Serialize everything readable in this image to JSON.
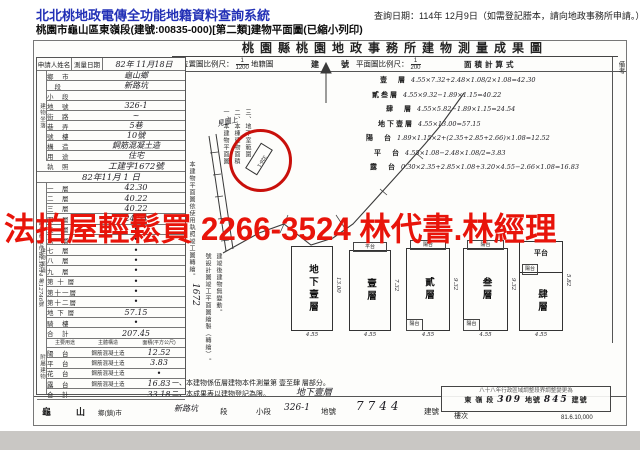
{
  "header": {
    "system_title": "北北桃地政電傳全功能地籍資料查詢系統",
    "query_date": "查詢日期：114年 12月9日（如需登記謄本，請向地政事務所申請。）",
    "subtitle": "桃園市龜山區東嶺段(建號:00835-000)[第二類]建物平面圖(已縮小列印)"
  },
  "watermark": {
    "text": "法拍屋輕鬆買 2266-3524 林代書.林經理",
    "color": "#e8140a"
  },
  "form": {
    "title": "桃園縣桃園地政事務所建物測量成果圖",
    "applicant_label": "申請人姓名",
    "survey_date_label": "測量日期",
    "survey_date": "82年 11月18日",
    "location_rows": [
      {
        "label": "鄉　市",
        "value": "龜山鄉"
      },
      {
        "label": "　段",
        "value": "新路坑"
      },
      {
        "label": "小　段",
        "value": ""
      },
      {
        "label": "地　號",
        "value": "326-1"
      },
      {
        "label": "街　路",
        "value": "~"
      },
      {
        "label": "巷　弄",
        "value": "5巷"
      },
      {
        "label": "號　樓",
        "value": "10號"
      },
      {
        "label": "構　造",
        "value": "鋼筋混凝土造"
      },
      {
        "label": "用　途",
        "value": "住宅"
      }
    ],
    "license_label": "執　照",
    "license_no": "工建字1672號",
    "license_date": "82年11月 1 日",
    "location_group_label": "建物坐落",
    "area_group_label": "建物面積",
    "annex_group_label": "附屬建物",
    "area_rows": [
      {
        "label": "一　層",
        "value": "42.30"
      },
      {
        "label": "二　層",
        "value": "40.22"
      },
      {
        "label": "三　層",
        "value": "40.22"
      },
      {
        "label": "四　層",
        "value": "24.54"
      },
      {
        "label": "五　層",
        "value": "•"
      },
      {
        "label": "六　層",
        "value": "•"
      },
      {
        "label": "七　層",
        "value": "•"
      },
      {
        "label": "八　層",
        "value": "•"
      },
      {
        "label": "九　層",
        "value": "•"
      },
      {
        "label": "第 十 層",
        "value": "•"
      },
      {
        "label": "第十一層",
        "value": "•"
      },
      {
        "label": "第十二層",
        "value": "•"
      },
      {
        "label": "地 下 層",
        "value": "57.15"
      },
      {
        "label": "騎　樓",
        "value": "•"
      },
      {
        "label": "合　計",
        "value": "207.45"
      }
    ],
    "annex_headers": [
      "主要用途",
      "主體構造",
      "面積(平方公尺)"
    ],
    "annex_rows": [
      {
        "use": "陽　台",
        "structure": "鋼筋混凝土造",
        "area": "12.52"
      },
      {
        "use": "平　台",
        "structure": "鋼筋混凝土造",
        "area": "3.83"
      },
      {
        "use": "花　台",
        "structure": "鋼筋混凝土造",
        "area": "•"
      },
      {
        "use": "露　台",
        "structure": "鋼筋混凝土造",
        "area": "16.83"
      },
      {
        "use": "合　計",
        "structure": "",
        "area": "33.18"
      }
    ],
    "receipt_side": "申請書 收件 82.10.14 第12746號",
    "map": {
      "scale_prefix": "位置圖比例尺：",
      "scale_num": "1",
      "scale_den": "1200",
      "kind": "地籍圖",
      "notes_vertical": [
        "一、本建物平面圖",
        "二、本棟建物面積",
        "三、地下室範圍"
      ],
      "side_note": "本建物平面圖依使用執照竣工圖轉繪。",
      "permit_hand": "1672",
      "permit_note": "號設計圖竣工平面圖繪製（轉繪）。",
      "permit_note2": "建竣後建物無變動。",
      "circle_note": "見圖上",
      "circle_parcel": "326-1"
    },
    "plan": {
      "scale_prefix": "平面圖比例尺：",
      "scale_num": "1",
      "scale_den": "200",
      "calc_title": "面積計算式",
      "building_no_label": "建　號",
      "remark_label": "備考",
      "calcs": [
        {
          "name": "壹　層",
          "expr": "4.55×7.32+2.48×1.08/2×1.08=42.30"
        },
        {
          "name": "貳叁層",
          "expr": "4.55×9.32−1.89×1.15=40.22"
        },
        {
          "name": "肆　層",
          "expr": "4.55×5.82−1.89×1.15=24.54"
        },
        {
          "name": "地下壹層",
          "expr": "4.55×13.00=57.15"
        },
        {
          "name": "陽　台",
          "expr": "1.89×1.15×2+(2.35+2.85+2.66)×1.08=12.52"
        },
        {
          "name": "平　台",
          "expr": "4.55×1.08−2.48×1.08/2=3.83"
        },
        {
          "name": "露　台",
          "expr": "0.30×2.35+2.85×1.08+3.20×4.55−2.66×1.08=16.83"
        }
      ]
    },
    "floors": [
      {
        "label": "地下壹層",
        "w": "4.55",
        "h": "13.00",
        "top": "",
        "bottom": ""
      },
      {
        "label": "壹層",
        "w": "4.55",
        "h": "7.32",
        "top": "平台",
        "bottom": ""
      },
      {
        "label": "貳層",
        "w": "4.55",
        "h": "9.32",
        "top": "陽台",
        "bottom": "陽台"
      },
      {
        "label": "叁層",
        "w": "4.55",
        "h": "9.32",
        "top": "陽台",
        "bottom": "陽台"
      },
      {
        "label": "肆層",
        "w": "4.55",
        "h": "5.82",
        "top": "平台",
        "bottom": "陽台"
      }
    ],
    "notes": [
      "一、本建物係伍層建物本件測量第 壹至肆 層部分。",
      "二、本成果表以建物登記為限。"
    ],
    "notes_hand": "地下壹層",
    "bottom": {
      "city": "龜　山",
      "city_suffix": "鄉(鎮)市",
      "section_hand": "新路坑",
      "section_label": "段",
      "subsection_label": "小段",
      "parcel": "326-1",
      "parcel_label": "地號",
      "building_no": "7744",
      "building_no_label": "建號",
      "floor_label": "樓次",
      "print_code": "81.6.10,000"
    },
    "stamp": {
      "line1": "八十八年行政區域調整段界調整變更為",
      "section": "東 嶺 段",
      "parcel": "309",
      "parcel_label": "地號",
      "bno": "845",
      "bno_label": "建號"
    }
  }
}
